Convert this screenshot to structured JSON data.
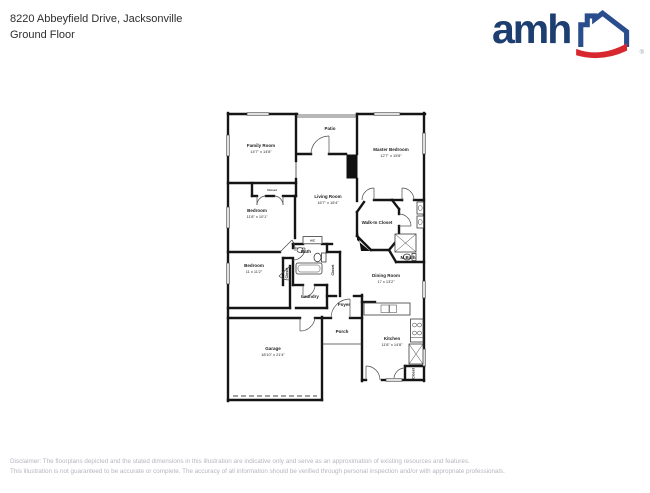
{
  "header": {
    "address": "8220 Abbeyfield Drive, Jacksonville",
    "floor_label": "Ground Floor"
  },
  "logo": {
    "wordmark": "amh",
    "registered_mark": "®",
    "colors": {
      "navy": "#1d3e70",
      "house_blue": "#2a4d8e",
      "swoosh_red": "#d7282f"
    }
  },
  "floor_plan": {
    "rooms": {
      "family_room": {
        "name": "Family Room",
        "dims": "14'7\" x 14'8\""
      },
      "patio": {
        "name": "Patio"
      },
      "master_bedroom": {
        "name": "Master Bedroom",
        "dims": "12'7\" x 15'8\""
      },
      "living_room": {
        "name": "Living Room",
        "dims": "16'7\" x 16'4\""
      },
      "bedroom_2": {
        "name": "Bedroom",
        "dims": "11'8\" x 10'1\""
      },
      "bedroom_3": {
        "name": "Bedroom",
        "dims": "11 x 11'2\""
      },
      "walk_in_closet": {
        "name": "Walk-In Closet"
      },
      "m_bath": {
        "name": "M.Bath"
      },
      "bath": {
        "name": "Bath"
      },
      "ac_closet": {
        "name": "A/C"
      },
      "laundry": {
        "name": "Laundry"
      },
      "dining_room": {
        "name": "Dining Room",
        "dims": "17 x 13'2\""
      },
      "kitchen": {
        "name": "Kitchen",
        "dims": "11'8\" x 14'8\""
      },
      "foyer": {
        "name": "Foyer"
      },
      "porch": {
        "name": "Porch"
      },
      "garage": {
        "name": "Garage",
        "dims": "18'10\" x 21'4\""
      },
      "closet_hall": {
        "name": "Closet"
      },
      "closet_bath_l": {
        "name": "Closet"
      },
      "closet_bath_r": {
        "name": "Closet"
      },
      "closet_kitchen": {
        "name": "Closet"
      }
    }
  },
  "disclaimer": {
    "line1": "Disclaimer: The floorplans depicted and the stated dimensions in this illustration are indicative only and serve as an approximation of existing resources and features.",
    "line2": "This illustration is not guaranteed to be accurate or complete. The accuracy of all information should be verified through personal inspection and/or with appropriate professionals."
  }
}
